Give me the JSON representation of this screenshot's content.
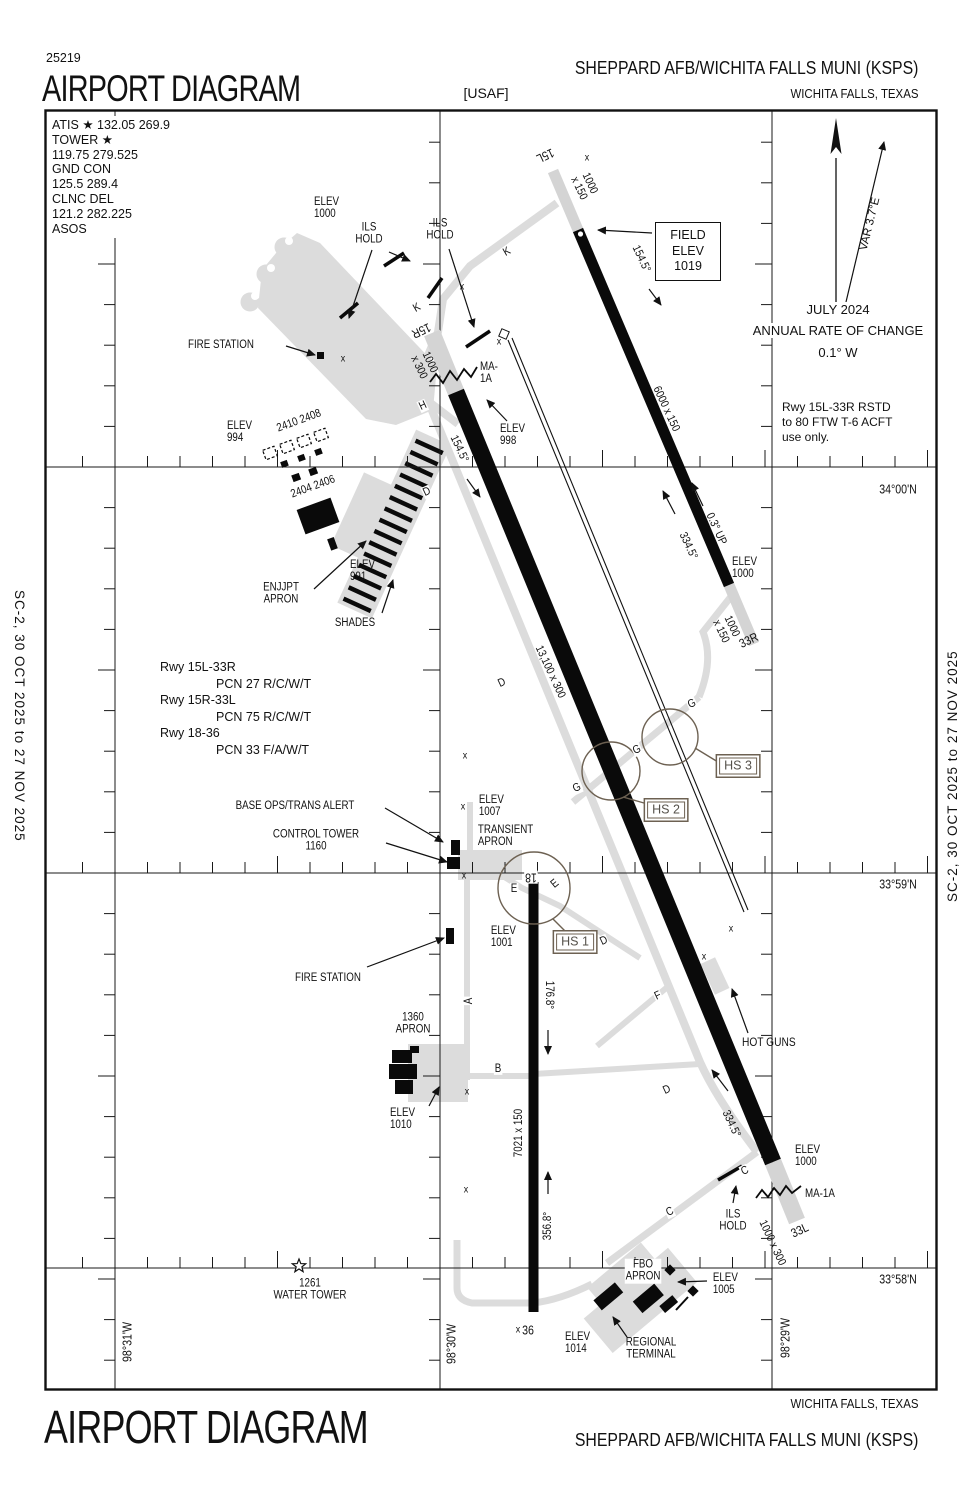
{
  "colors": {
    "ink": "#111111",
    "taxiway": "#dcdcdc",
    "runway": "#0a0a0a",
    "hotspot_brown": "#6d6152",
    "white": "#ffffff"
  },
  "header": {
    "chart_code": "25219",
    "title": "AIRPORT DIAGRAM",
    "operator": "[USAF]",
    "airport": "SHEPPARD AFB/WICHITA FALLS MUNI   (KSPS)",
    "city": "WICHITA FALLS, TEXAS"
  },
  "footer": {
    "title": "AIRPORT DIAGRAM",
    "city": "WICHITA FALLS, TEXAS",
    "airport": "SHEPPARD AFB/WICHITA FALLS MUNI   (KSPS)"
  },
  "edge_note": "SC-2,  30 OCT 2025  to  27 NOV 2025",
  "comms": {
    "l1": "ATIS ★ 132.05  269.9",
    "l2": "TOWER ★",
    "l3": "119.75  279.525",
    "l4": "GND CON",
    "l5": "125.5  289.4",
    "l6": "CLNC DEL",
    "l7": "121.2  282.225",
    "l8": "ASOS"
  },
  "field_elev": {
    "l1": "FIELD",
    "l2": "ELEV",
    "l3": "1019"
  },
  "compass": {
    "date": "JULY 2024",
    "label": "ANNUAL RATE OF CHANGE",
    "rate": "0.1° W",
    "variation": "VAR 3.7°E"
  },
  "restriction_note": {
    "l1": "Rwy 15L-33R RSTD",
    "l2": "to 80 FTW T-6 ACFT",
    "l3": "use only."
  },
  "pcn": {
    "l1": "Rwy 15L-33R",
    "l2": "PCN 27 R/C/W/T",
    "l3": "Rwy 15R-33L",
    "l4": "PCN 75 R/C/W/T",
    "l5": "Rwy 18-36",
    "l6": "PCN 33 F/A/W/T"
  },
  "hotspots": [
    {
      "label": "HS 1",
      "x": 575,
      "y": 942
    },
    {
      "label": "HS 2",
      "x": 666,
      "y": 810
    },
    {
      "label": "HS 3",
      "x": 738,
      "y": 766
    }
  ],
  "map_labels": [
    {
      "n": "elev-1000-nw-label",
      "t": "ELEV\n1000",
      "x": 314,
      "y": 196,
      "al": "l"
    },
    {
      "n": "ils-hold-nw-label",
      "t": "ILS\nHOLD",
      "x": 369,
      "y": 234
    },
    {
      "n": "ils-hold-n-label",
      "t": "ILS\nHOLD",
      "x": 440,
      "y": 230
    },
    {
      "n": "rwy-15l-number",
      "t": "15L",
      "x": 545,
      "y": 155,
      "rot": 155,
      "fs": 12.5
    },
    {
      "n": "rwy-15l-overrun-dim",
      "t": "1000\nx 150",
      "x": 584,
      "y": 186,
      "rot": 65
    },
    {
      "n": "rwy-15l-heading",
      "t": "154.5°",
      "x": 641,
      "y": 259,
      "rot": 65
    },
    {
      "n": "rwy-15l-dim",
      "t": "6000 x 150",
      "x": 666,
      "y": 409,
      "rot": 65
    },
    {
      "n": "rwy-33r-number",
      "t": "33R",
      "x": 749,
      "y": 641,
      "rot": -25,
      "fs": 12.5
    },
    {
      "n": "rwy-33r-overrun-dim",
      "t": "1000\nx 150",
      "x": 726,
      "y": 629,
      "rot": 65
    },
    {
      "n": "rwy-33r-heading",
      "t": "334.5°",
      "x": 688,
      "y": 546,
      "rot": 65
    },
    {
      "n": "rwy-33r-gradient",
      "t": "0.3° UP",
      "x": 716,
      "y": 529,
      "rot": 65
    },
    {
      "n": "elev-1000-33r-label",
      "t": "ELEV\n1000",
      "x": 732,
      "y": 556,
      "al": "l"
    },
    {
      "n": "rwy-15r-number",
      "t": "15R",
      "x": 421,
      "y": 330,
      "rot": 155,
      "fs": 12.5
    },
    {
      "n": "rwy-15r-overrun-dim",
      "t": "1000\nx 300",
      "x": 424,
      "y": 365,
      "rot": 65
    },
    {
      "n": "rwy-15r-heading",
      "t": "154.5°",
      "x": 459,
      "y": 449,
      "rot": 65
    },
    {
      "n": "ma1a-north-label",
      "t": "MA-\n1A",
      "x": 480,
      "y": 361,
      "al": "l"
    },
    {
      "n": "elev-998-label",
      "t": "ELEV\n998",
      "x": 500,
      "y": 423,
      "al": "l"
    },
    {
      "n": "taxiway-k-label-1",
      "t": "K",
      "x": 507,
      "y": 252,
      "rot": -30,
      "halo": true
    },
    {
      "n": "taxiway-k-label-2",
      "t": "K",
      "x": 417,
      "y": 308,
      "rot": -30,
      "halo": true
    },
    {
      "n": "taxiway-h-label",
      "t": "H",
      "x": 423,
      "y": 406,
      "rot": -25,
      "halo": true
    },
    {
      "n": "fire-station-north-label",
      "t": "FIRE STATION",
      "x": 188,
      "y": 339,
      "al": "l"
    },
    {
      "n": "elev-994-label",
      "t": "ELEV\n994",
      "x": 227,
      "y": 420,
      "al": "l"
    },
    {
      "n": "building-2410-2408-label",
      "t": "2410 2408",
      "x": 299,
      "y": 421,
      "rot": -20
    },
    {
      "n": "building-2404-2406-label",
      "t": "2404 2406",
      "x": 313,
      "y": 487,
      "rot": -20
    },
    {
      "n": "enjjpt-apron-label",
      "t": "ENJJPT\nAPRON",
      "x": 281,
      "y": 594
    },
    {
      "n": "elev-991-label",
      "t": "ELEV\n991",
      "x": 350,
      "y": 559,
      "al": "l"
    },
    {
      "n": "shades-label",
      "t": "SHADES",
      "x": 355,
      "y": 623
    },
    {
      "n": "rwy-15r-dim",
      "t": "13,100 x 300",
      "x": 550,
      "y": 672,
      "rot": 65
    },
    {
      "n": "taxiway-d-label-1",
      "t": "D",
      "x": 427,
      "y": 492,
      "rot": -25,
      "halo": true
    },
    {
      "n": "taxiway-d-label-2",
      "t": "D",
      "x": 502,
      "y": 683,
      "rot": -25,
      "halo": true
    },
    {
      "n": "taxiway-d-label-3",
      "t": "D",
      "x": 604,
      "y": 941,
      "rot": -25,
      "halo": true
    },
    {
      "n": "taxiway-d-label-4",
      "t": "D",
      "x": 667,
      "y": 1090,
      "rot": -25,
      "halo": true
    },
    {
      "n": "taxiway-g-label-1",
      "t": "G",
      "x": 577,
      "y": 788,
      "rot": -25,
      "halo": true
    },
    {
      "n": "taxiway-g-label-2",
      "t": "G",
      "x": 637,
      "y": 750,
      "rot": -25,
      "halo": true
    },
    {
      "n": "taxiway-g-label-3",
      "t": "G",
      "x": 692,
      "y": 704,
      "rot": -25,
      "halo": true
    },
    {
      "n": "base-ops-label",
      "t": "BASE OPS/TRANS ALERT",
      "x": 295,
      "y": 806
    },
    {
      "n": "control-tower-label",
      "t": "CONTROL TOWER\n1160",
      "x": 316,
      "y": 841
    },
    {
      "n": "elev-1007-label",
      "t": "ELEV\n1007",
      "x": 478,
      "y": 794,
      "al": "l",
      "halo": true
    },
    {
      "n": "transient-apron-label",
      "t": "TRANSIENT\nAPRON",
      "x": 477,
      "y": 824,
      "al": "l",
      "halo": true
    },
    {
      "n": "rwy-18-number",
      "t": "18",
      "x": 531,
      "y": 877,
      "rot": 180,
      "fs": 12.5,
      "halo": true
    },
    {
      "n": "taxiway-e-label-1",
      "t": "E",
      "x": 514,
      "y": 889,
      "halo": true
    },
    {
      "n": "taxiway-e-label-2",
      "t": "E",
      "x": 555,
      "y": 884,
      "rot": -40,
      "halo": true
    },
    {
      "n": "elev-1001-label",
      "t": "ELEV\n1001",
      "x": 490,
      "y": 925,
      "al": "l",
      "halo": true
    },
    {
      "n": "fire-station-south-label",
      "t": "FIRE STATION",
      "x": 295,
      "y": 972,
      "al": "l"
    },
    {
      "n": "taxiway-a-label",
      "t": "A",
      "x": 469,
      "y": 1001,
      "rot": -90,
      "halo": true
    },
    {
      "n": "apron-1360-label",
      "t": "1360\nAPRON",
      "x": 413,
      "y": 1024
    },
    {
      "n": "taxiway-b-label",
      "t": "B",
      "x": 498,
      "y": 1069,
      "halo": true
    },
    {
      "n": "elev-1010-label",
      "t": "ELEV\n1010",
      "x": 390,
      "y": 1107,
      "al": "l"
    },
    {
      "n": "rwy-18-36-dim",
      "t": "7021 x 150",
      "x": 519,
      "y": 1133,
      "rot": -90
    },
    {
      "n": "rwy-18-heading",
      "t": "176.8°",
      "x": 549,
      "y": 995,
      "rot": 90
    },
    {
      "n": "rwy-36-heading",
      "t": "356.8°",
      "x": 548,
      "y": 1226,
      "rot": -90
    },
    {
      "n": "taxiway-f-label",
      "t": "F",
      "x": 658,
      "y": 996,
      "rot": -25,
      "halo": true
    },
    {
      "n": "hot-guns-label",
      "t": "HOT GUNS",
      "x": 742,
      "y": 1036,
      "al": "l",
      "fs": 12
    },
    {
      "n": "rwy-33l-heading",
      "t": "334.5°",
      "x": 731,
      "y": 1124,
      "rot": 65
    },
    {
      "n": "elev-1000-33l-label",
      "t": "ELEV\n1000",
      "x": 795,
      "y": 1144,
      "al": "l"
    },
    {
      "n": "ma1a-south-label",
      "t": "MA-1A",
      "x": 805,
      "y": 1188,
      "al": "l"
    },
    {
      "n": "rwy-33l-number",
      "t": "33L",
      "x": 800,
      "y": 1231,
      "rot": -25,
      "fs": 12.5
    },
    {
      "n": "rwy-33l-overrun-dim",
      "t": "1000 x 300",
      "x": 772,
      "y": 1243,
      "rot": 65
    },
    {
      "n": "taxiway-c-label-1",
      "t": "C",
      "x": 745,
      "y": 1171,
      "rot": -25,
      "halo": true
    },
    {
      "n": "taxiway-c-label-2",
      "t": "C",
      "x": 670,
      "y": 1212,
      "rot": -25,
      "halo": true
    },
    {
      "n": "ils-hold-s-label",
      "t": "ILS\nHOLD",
      "x": 733,
      "y": 1221,
      "halo": true
    },
    {
      "n": "rwy-36-number",
      "t": "36",
      "x": 528,
      "y": 1331,
      "fs": 12.5,
      "halo": true
    },
    {
      "n": "elev-1014-label",
      "t": "ELEV\n1014",
      "x": 565,
      "y": 1331,
      "al": "l"
    },
    {
      "n": "fbo-apron-label",
      "t": "FBO\nAPRON",
      "x": 643,
      "y": 1271,
      "halo": true
    },
    {
      "n": "elev-1005-label",
      "t": "ELEV\n1005",
      "x": 712,
      "y": 1272,
      "al": "l",
      "halo": true
    },
    {
      "n": "regional-terminal-label",
      "t": "REGIONAL\nTERMINAL",
      "x": 651,
      "y": 1349
    },
    {
      "n": "water-tower-label",
      "t": "1261\nWATER TOWER",
      "x": 310,
      "y": 1290
    },
    {
      "n": "lat-34-00",
      "t": "34°00'N",
      "x": 898,
      "y": 490,
      "fs": 12.5
    },
    {
      "n": "lat-33-59",
      "t": "33°59'N",
      "x": 898,
      "y": 885,
      "fs": 12.5
    },
    {
      "n": "lat-33-58",
      "t": "33°58'N",
      "x": 898,
      "y": 1280,
      "fs": 12.5
    },
    {
      "n": "lon-98-31",
      "t": "98°31'W",
      "x": 128,
      "y": 1342,
      "rot": -90,
      "fs": 12.5
    },
    {
      "n": "lon-98-30",
      "t": "98°30'W",
      "x": 452,
      "y": 1344,
      "rot": -90,
      "fs": 12.5
    },
    {
      "n": "lon-98-29",
      "t": "98°29'W",
      "x": 786,
      "y": 1338,
      "rot": -90,
      "fs": 12.5
    },
    {
      "n": "obstruction-x",
      "t": "x",
      "x": 343,
      "y": 359,
      "fs": 10.5
    },
    {
      "n": "obstruction-x",
      "t": "x",
      "x": 462,
      "y": 287,
      "fs": 10.5
    },
    {
      "n": "obstruction-x",
      "t": "x",
      "x": 499,
      "y": 342,
      "fs": 10.5
    },
    {
      "n": "obstruction-x",
      "t": "x",
      "x": 587,
      "y": 158,
      "fs": 10.5
    },
    {
      "n": "obstruction-x",
      "t": "x",
      "x": 465,
      "y": 756,
      "fs": 10.5
    },
    {
      "n": "obstruction-x",
      "t": "x",
      "x": 463,
      "y": 807,
      "fs": 10.5
    },
    {
      "n": "obstruction-x",
      "t": "x",
      "x": 464,
      "y": 876,
      "fs": 10.5
    },
    {
      "n": "obstruction-x",
      "t": "x",
      "x": 467,
      "y": 1092,
      "fs": 10.5
    },
    {
      "n": "obstruction-x",
      "t": "x",
      "x": 466,
      "y": 1190,
      "fs": 10.5
    },
    {
      "n": "obstruction-x",
      "t": "x",
      "x": 518,
      "y": 1330,
      "fs": 10.5
    },
    {
      "n": "obstruction-x",
      "t": "x",
      "x": 731,
      "y": 929,
      "fs": 10.5
    },
    {
      "n": "obstruction-x",
      "t": "x",
      "x": 704,
      "y": 957,
      "fs": 10.5
    }
  ]
}
